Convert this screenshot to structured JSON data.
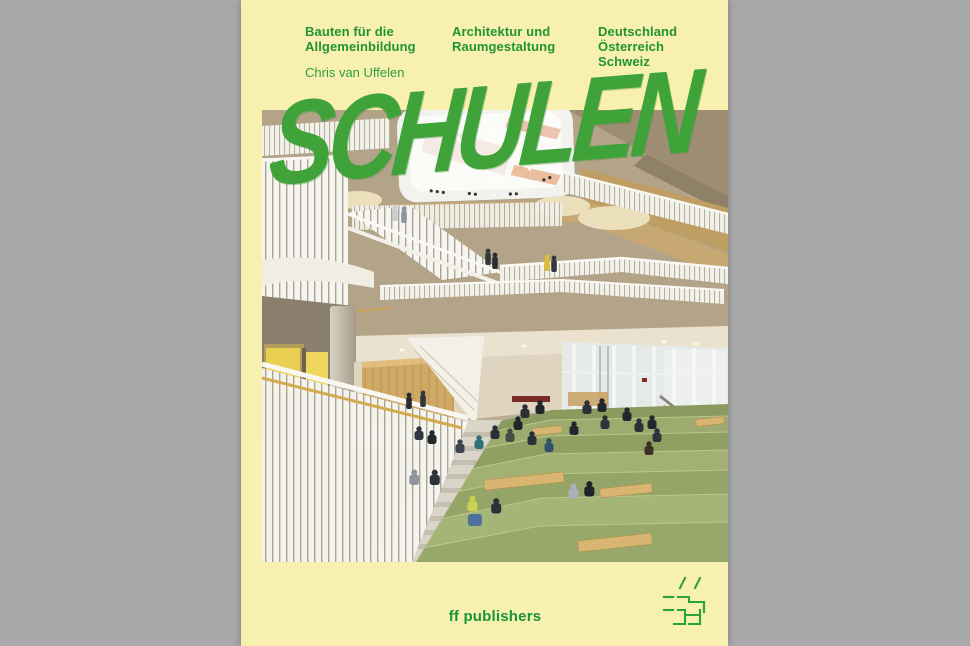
{
  "page": {
    "background_gray": "#a9a9a9"
  },
  "cover": {
    "background_yellow": "#f8f0ae",
    "accent_green": "#1f9434",
    "title_green": "#3fa33a",
    "photo_step_green": "#9aa96b",
    "header": {
      "columns": [
        {
          "lines": [
            "Bauten für die",
            "Allgemeinbildung"
          ]
        },
        {
          "lines": [
            "Architektur und",
            "Raumgestaltung"
          ]
        },
        {
          "lines": [
            "Deutschland",
            "Österreich",
            "Schweiz"
          ]
        }
      ],
      "author": "Chris van Uffelen"
    },
    "title": "SCHULEN",
    "footer": {
      "publisher": "ff publishers",
      "logo_icon": "double-hash-icon"
    }
  }
}
